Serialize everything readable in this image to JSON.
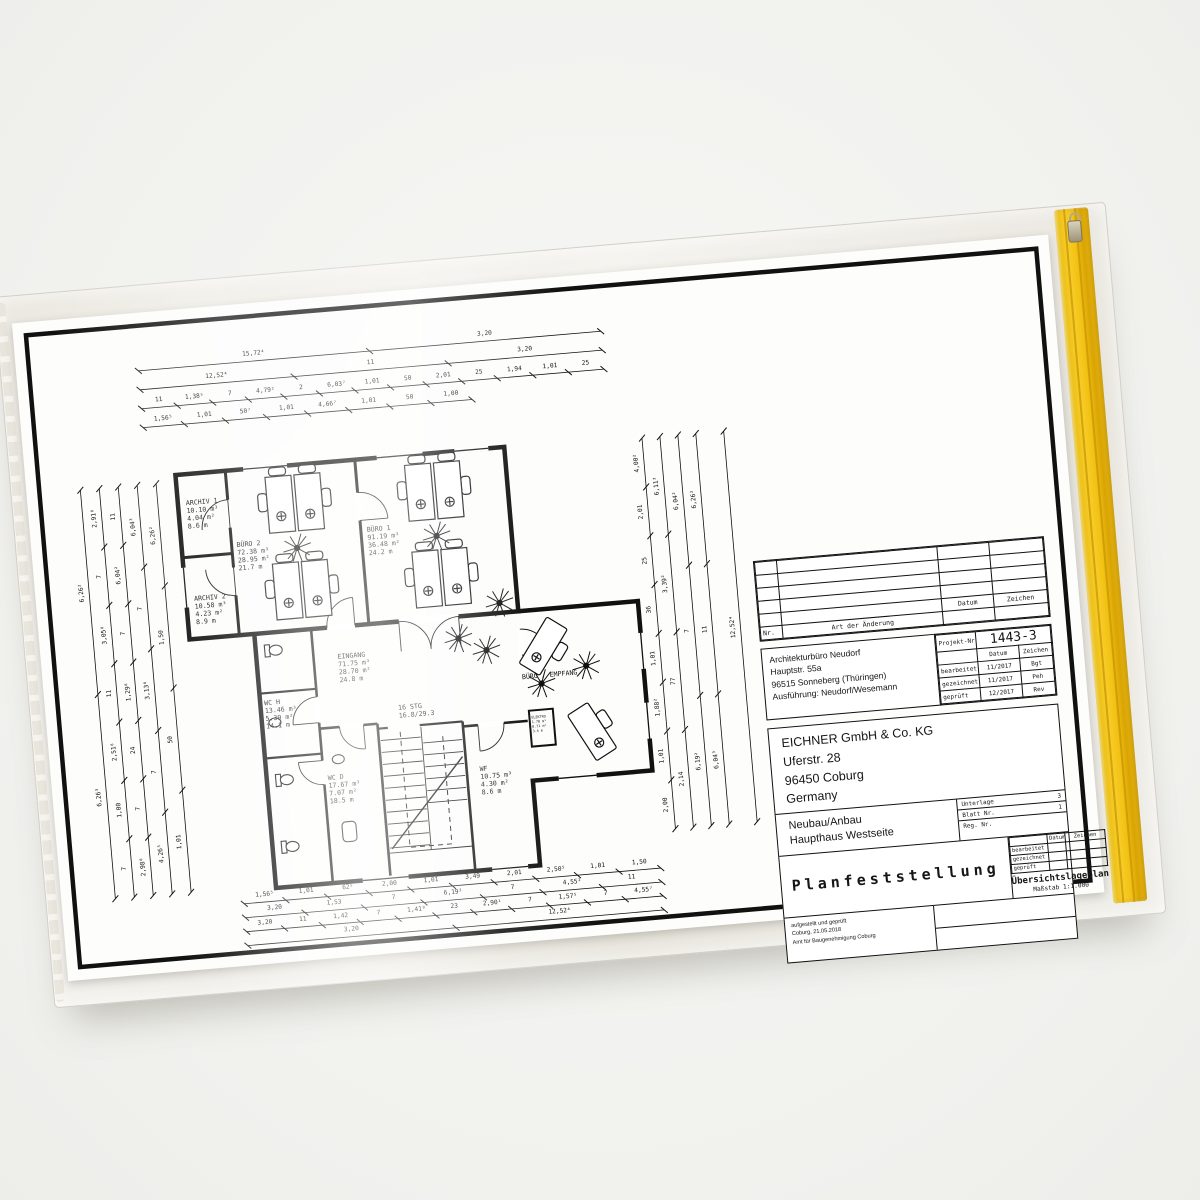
{
  "product": {
    "sleeve_color": "#e9e6de",
    "zip_color": "#f2c113",
    "paper_color": "#fdfdfc",
    "frame_color": "#111111"
  },
  "plan": {
    "rooms": [
      {
        "name": "ARCHIV 1",
        "l1": "10.10 m³",
        "l2": "4.04 m²",
        "l3": "8.6 m"
      },
      {
        "name": "BÜRO 2",
        "l1": "72.38 m³",
        "l2": "28.95 m²",
        "l3": "21.7 m"
      },
      {
        "name": "ARCHIV 2",
        "l1": "10.58 m³",
        "l2": "4.23 m²",
        "l3": "8.9 m"
      },
      {
        "name": "BÜRO 1",
        "l1": "91.19 m³",
        "l2": "36.48 m²",
        "l3": "24.2 m"
      },
      {
        "name": "EINGANG",
        "l1": "71.75 m³",
        "l2": "28.70 m²",
        "l3": "24.8 m"
      },
      {
        "name": "WC H",
        "l1": "13.46 m³",
        "l2": "5.39 m²",
        "l3": "14.1 m"
      },
      {
        "name": "WC D",
        "l1": "17.67 m³",
        "l2": "7.07 m²",
        "l3": "18.5 m"
      },
      {
        "name": "WF",
        "l1": "10.75 m³",
        "l2": "4.30 m²",
        "l3": "8.6 m"
      },
      {
        "name": "ELEKTRO",
        "l1": "1.78 m³",
        "l2": "0.71 m²",
        "l3": "3.4 m"
      },
      {
        "name": "BÜRO / EMPFANG",
        "l1": "",
        "l2": "",
        "l3": ""
      }
    ],
    "stairs": {
      "line1": "16 STG",
      "line2": "16.8/29.3"
    }
  },
  "dimensions": {
    "top": [
      [
        "15,72⁴",
        "3,20"
      ],
      [
        "12,52⁴",
        "11",
        "3,20"
      ],
      [
        "11",
        "1,38⁵",
        "7",
        "4,79²",
        "2",
        "6,03⁷",
        "1,01",
        "50",
        "2,01",
        "25",
        "1,94",
        "1,01",
        "25"
      ],
      [
        "1,56⁵",
        "1,01",
        "50⁷",
        "1,01",
        "4,66⁷",
        "1,01",
        "50",
        "1,00"
      ]
    ],
    "bottom": [
      [
        "1,56⁵",
        "1,01",
        "62⁵",
        "2,00",
        "1,01",
        "3,49",
        "2,01",
        "2,50⁵",
        "1,01",
        "1,50"
      ],
      [
        "3,20",
        "1,53",
        "7",
        "6,19²",
        "7",
        "4,55²",
        "11"
      ],
      [
        "3,20",
        "11",
        "1,42",
        "7",
        "1,41⁸",
        "23",
        "2,90¹",
        "7",
        "1,57⁵",
        "7",
        "4,55⁷"
      ],
      [
        "3,20",
        "12,52⁴"
      ]
    ],
    "left": [
      [
        "6,26²",
        "6,26³"
      ],
      [
        "2,91⁸",
        "7",
        "3,05⁸",
        "11",
        "2,51⁸",
        "1,00",
        "7"
      ],
      [
        "11",
        "6,04²",
        "7",
        "1,29⁸",
        "24",
        "7",
        "2,98⁸"
      ],
      [
        "6,04³",
        "7",
        "3,13⁸",
        "7",
        "4,26³"
      ],
      [
        "6,26²",
        "1,50",
        "50",
        "1,01"
      ]
    ],
    "right": [
      [
        "4,00²",
        "2,01",
        "25",
        "36",
        "1,01",
        "1,88²",
        "1,01",
        "2,00"
      ],
      [
        "6,11³",
        "3,39²",
        "77",
        "2,14"
      ],
      [
        "6,04²",
        "7",
        "6,19²"
      ],
      [
        "6,26²",
        "11",
        "6,04³"
      ],
      [
        "12,52⁴"
      ]
    ]
  },
  "title_block": {
    "revision": {
      "nr": "Nr.",
      "change": "Art der Änderung",
      "date": "Datum",
      "sign": "Zeichen"
    },
    "architect": {
      "line1": "Architekturbüro Neudorf",
      "line2": "Hauptstr. 55a",
      "line3": "96515 Sonneberg (Thüringen)",
      "line4": "Ausführung: Neudorf/Wesemann"
    },
    "project": {
      "label": "Projekt-Nr.:",
      "number": "1443-3",
      "date_h": "Datum",
      "sign_h": "Zeichen",
      "row1_label": "bearbeitet",
      "row1_date": "11/2017",
      "row1_sign": "Bgt",
      "row2_label": "gezeichnet",
      "row2_date": "11/2017",
      "row2_sign": "Peh",
      "row3_label": "geprüft",
      "row3_date": "12/2017",
      "row3_sign": "Rev"
    },
    "client": {
      "name": "EICHNER GmbH & Co. KG",
      "street": "Uferstr. 28",
      "city": "96450 Coburg",
      "country": "Germany"
    },
    "project_title": {
      "line1": "Neubau/Anbau",
      "line2": "Haupthaus Westseite"
    },
    "doc_refs": {
      "unterlage_label": "Unterlage",
      "unterlage_value": "3",
      "blatt_label": "Blatt Nr.",
      "blatt_value": "1",
      "reg_label": "Reg. Nr.",
      "reg_value": ""
    },
    "approval": {
      "title": "Planfeststellung",
      "date_h": "Datum",
      "sign_h": "Zeichen",
      "row1": "bearbeitet",
      "row2": "gezeichnet",
      "row3": "geprüft",
      "plan_type": "Übersichtslageplan",
      "scale": "Maßstab  1:1.000"
    },
    "stamp": {
      "line1": "aufgestellt und geprüft",
      "line2": "Coburg, 21.05.2018",
      "line3": "Amt für Baugenehmigung Coburg"
    }
  }
}
